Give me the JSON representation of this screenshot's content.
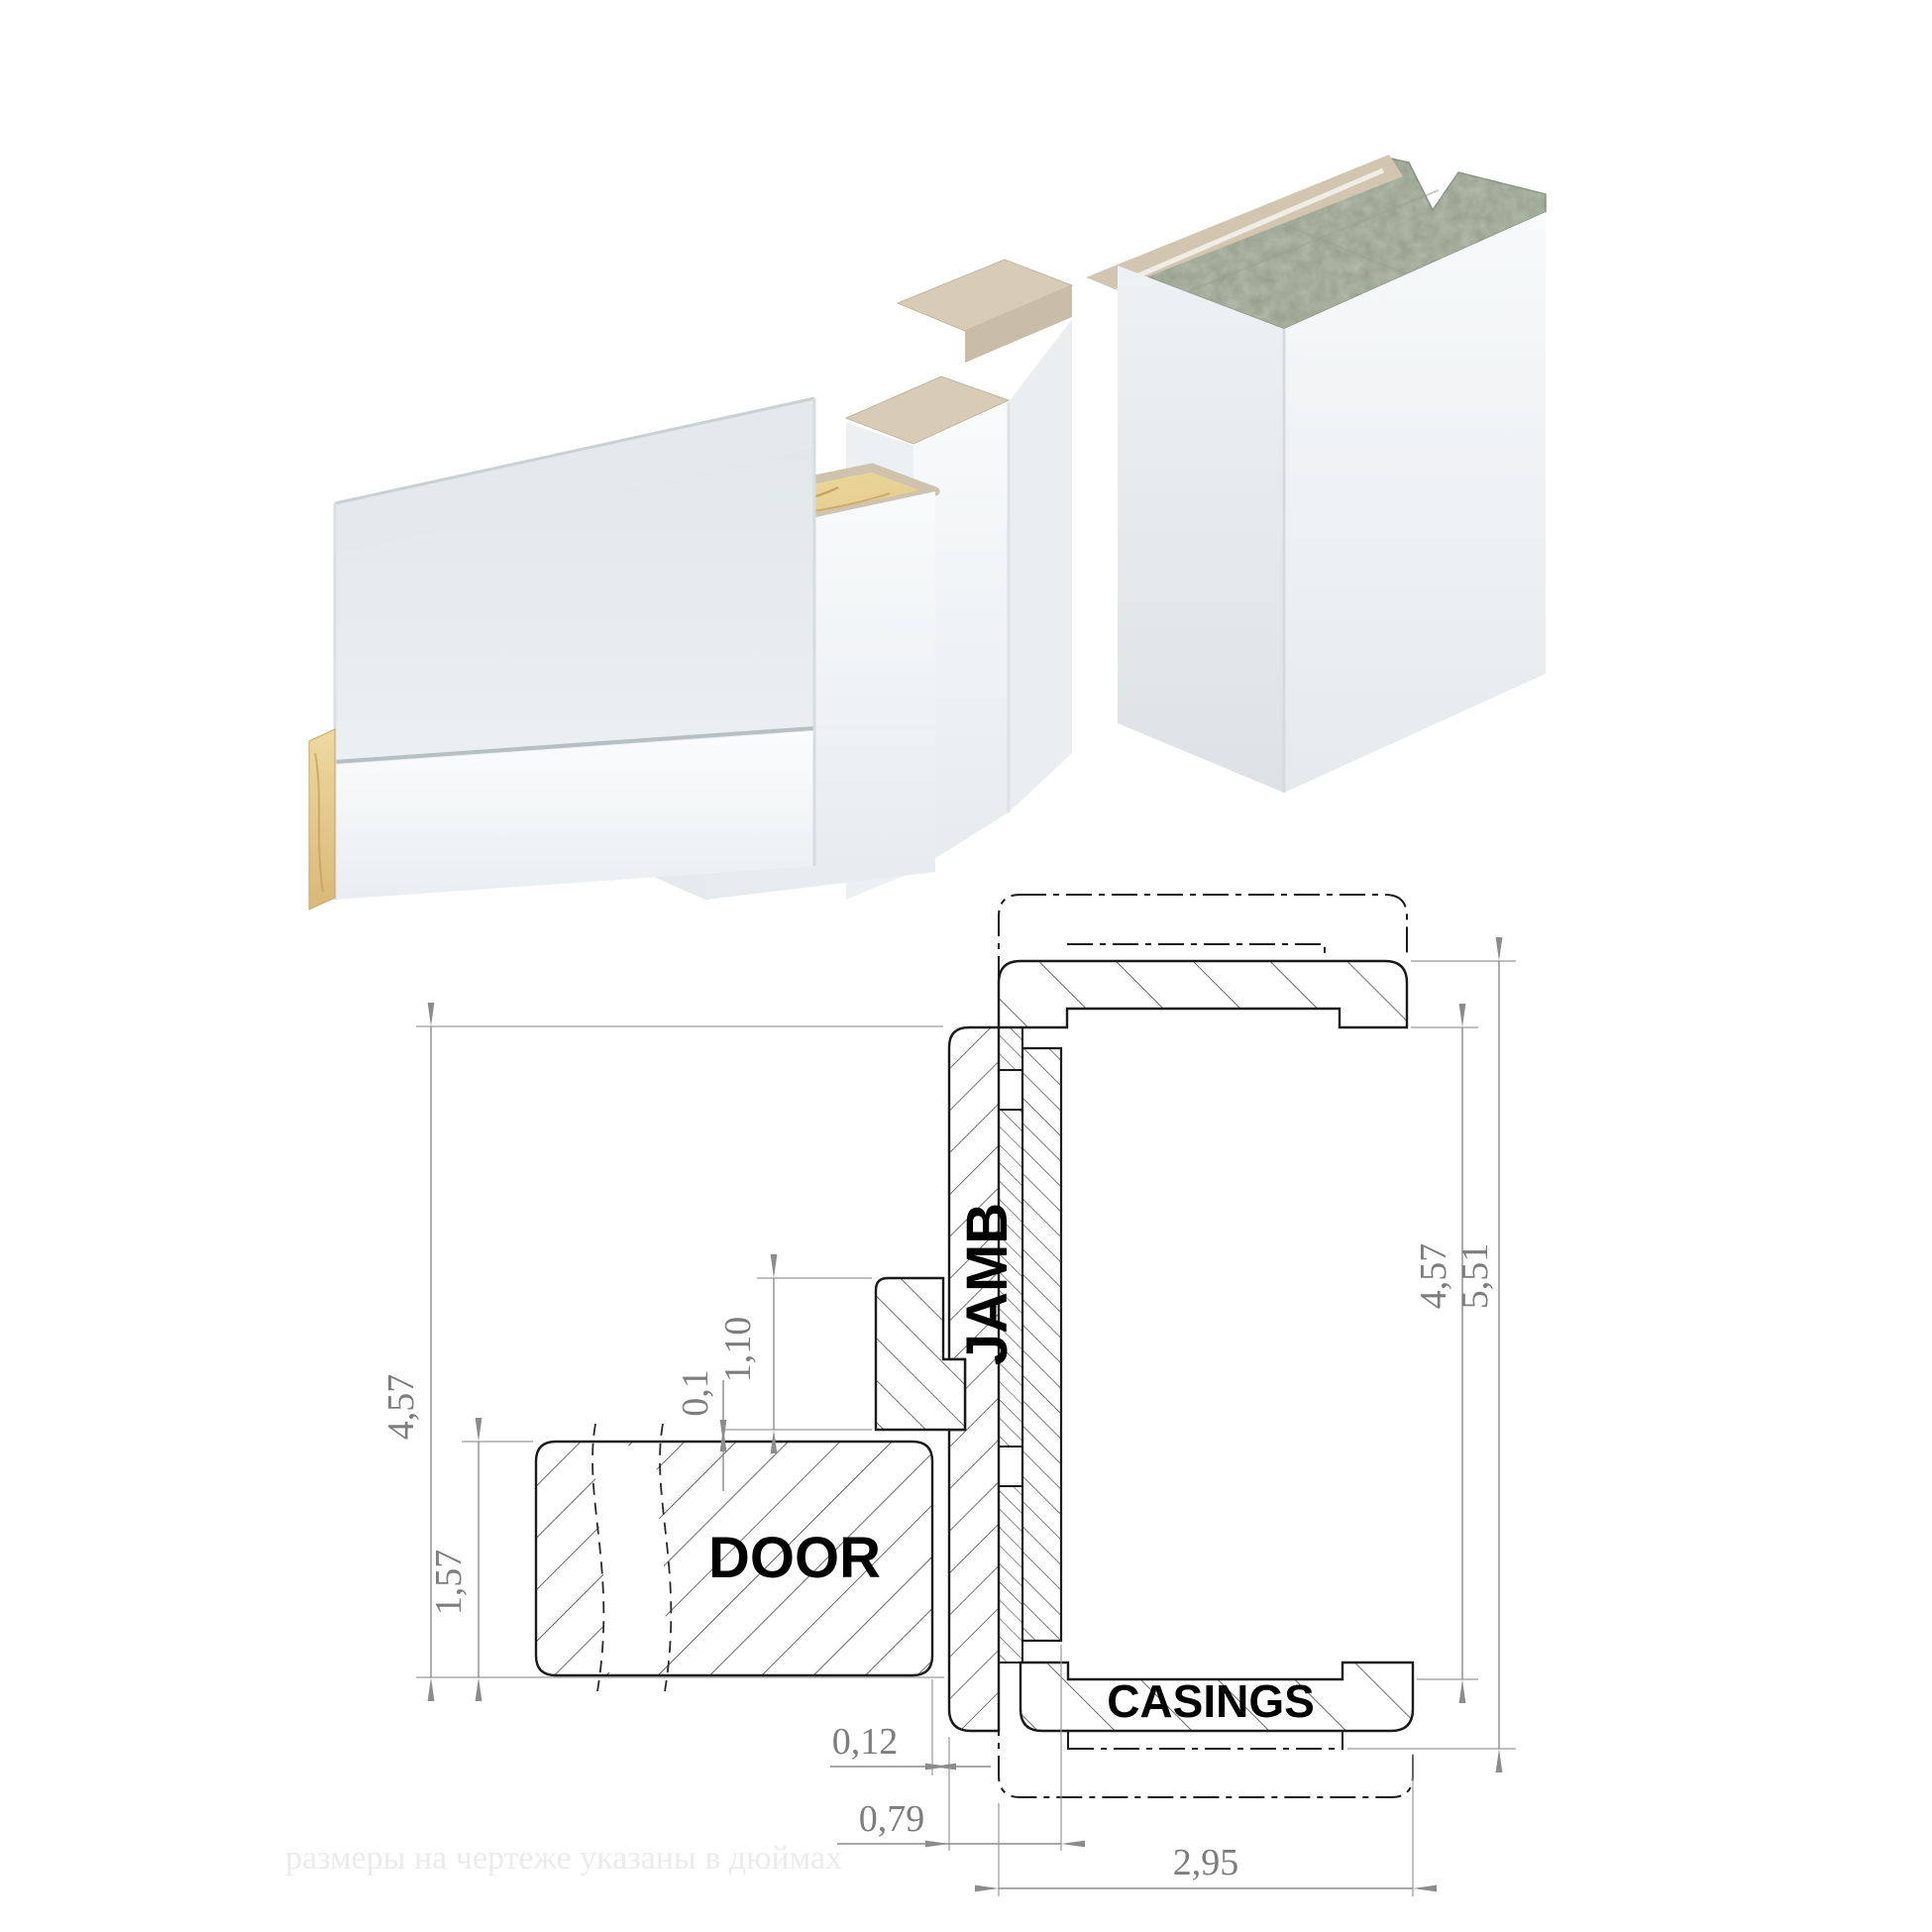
{
  "drawing": {
    "labels": {
      "door": "DOOR",
      "jamb": "JAMB",
      "casings": "CASINGS"
    },
    "dims": {
      "left_outer": {
        "value": "4,57",
        "meaning": "jamb board width"
      },
      "door_thickness": {
        "value": "1,57",
        "meaning": "door leaf thickness"
      },
      "stop_height": {
        "value": "1,10",
        "meaning": "door stop height"
      },
      "seal_gap": {
        "value": "0,1",
        "meaning": "gap door to stop"
      },
      "door_jamb_gap": {
        "value": "0,12",
        "meaning": "clearance door to jamb"
      },
      "jamb_depth": {
        "value": "0,79",
        "meaning": "jamb profile depth"
      },
      "casing_width": {
        "value": "2,95",
        "meaning": "casing width"
      },
      "right_inner": {
        "value": "4,57",
        "meaning": "opening inner width"
      },
      "right_outer": {
        "value": "5,51",
        "meaning": "overall width with casings"
      }
    },
    "watermark": "размеры на чертеже указаны в дюймах"
  },
  "colors": {
    "outline": "#1a1a1a",
    "hatch": "#3a3a3a",
    "dim_gray": "#8c8c8c",
    "concrete": "#b4bcab",
    "profile_beige": "#d8ccb6",
    "channel_beige": "#d2c6b0",
    "wood_light": "#f0dfa8",
    "wood_dark": "#e0c684",
    "door_face": "#e3e9ec",
    "panel_white": "#f6f8f9"
  }
}
